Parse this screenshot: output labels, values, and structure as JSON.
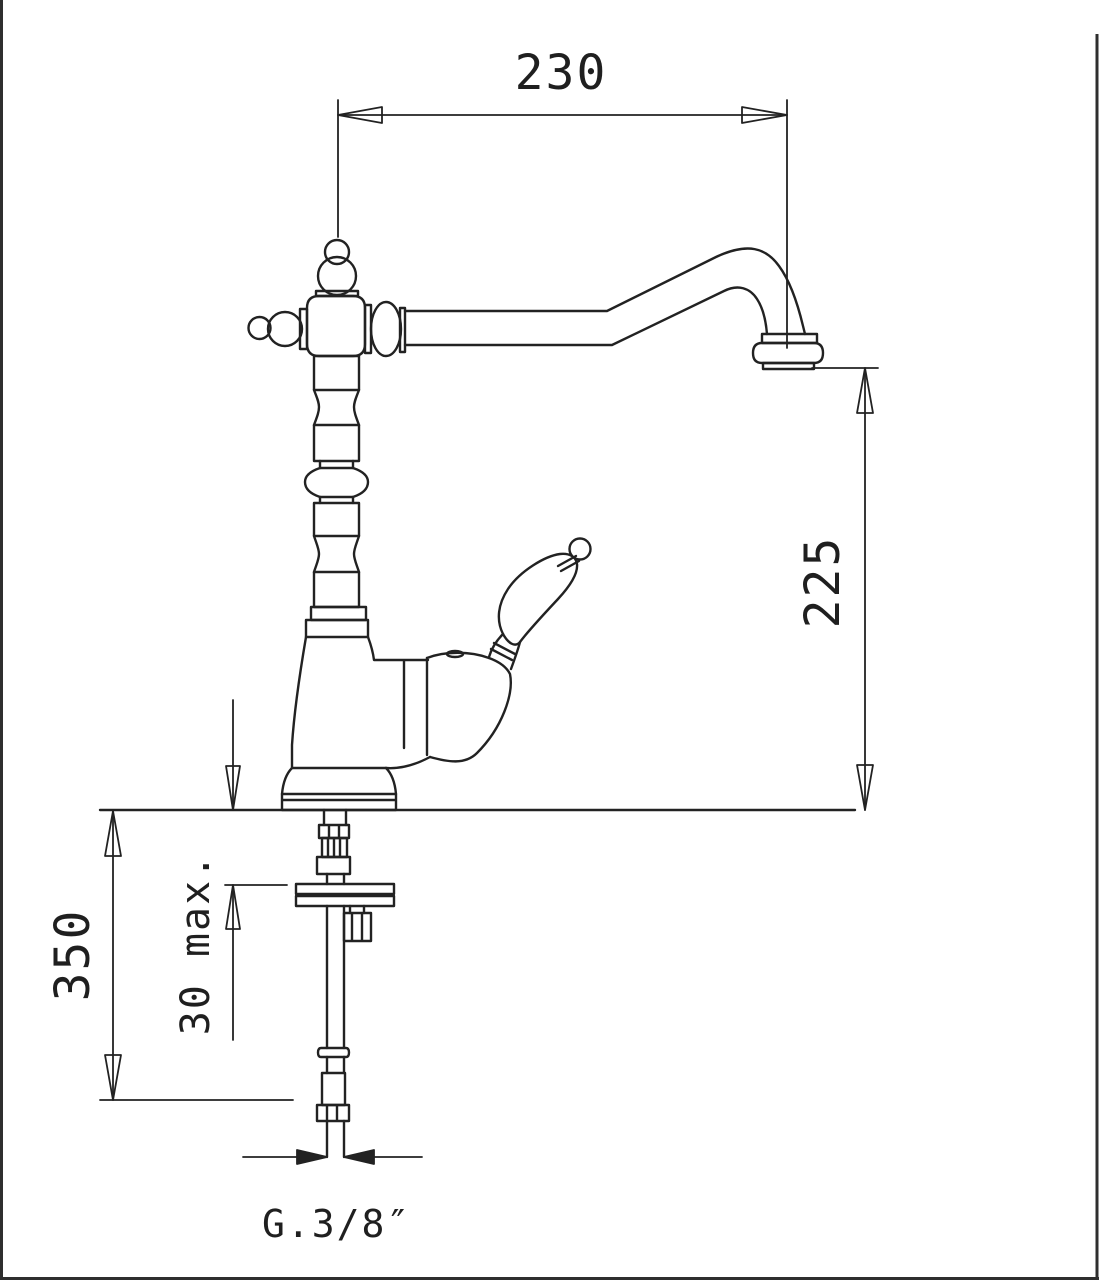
{
  "meta": {
    "description": "Technical dimension drawing of a classic single-lever kitchen faucet with under-counter supply pipe",
    "colors": {
      "background": "#ffffff",
      "line": "#222222",
      "border": "#2e2e2e",
      "text": "#1f1f1f"
    }
  },
  "dimensions": {
    "spout_reach": "230",
    "spout_height": "225",
    "below_counter_length": "350",
    "deck_max_thickness": "30 max.",
    "supply_thread": "G.3/8″"
  }
}
